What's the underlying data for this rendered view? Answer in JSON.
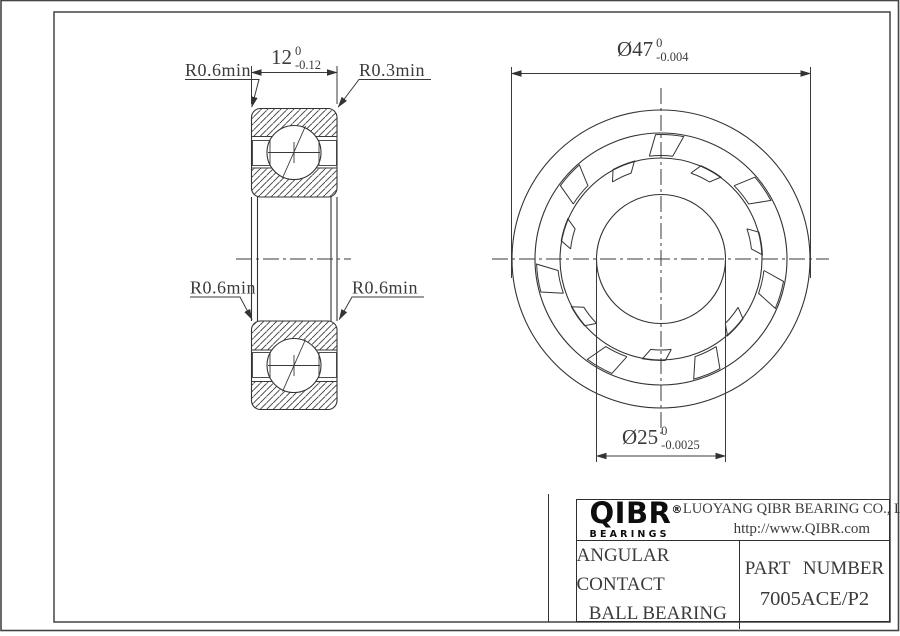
{
  "left_view": {
    "width_dim": {
      "value": "12",
      "tol_upper": "0",
      "tol_lower": "-0.12"
    },
    "radius_top_left": "R0.6min",
    "radius_top_right": "R0.3min",
    "radius_mid_left": "R0.6min",
    "radius_mid_right": "R0.6min"
  },
  "front_view": {
    "outer_dia": {
      "value": "Ø47",
      "tol_upper": "0",
      "tol_lower": "-0.004"
    },
    "bore_dia": {
      "value": "Ø25",
      "tol_upper": "0",
      "tol_lower": "-0.0025"
    }
  },
  "title_block": {
    "logo_text": "QIBR",
    "logo_registered": "®",
    "logo_tagline": "BEARINGS",
    "company_name": "LUOYANG QIBR BEARING CO., LTD",
    "website": "http://www.QIBR.com",
    "product_name_line1": "ANGULAR CONTACT",
    "product_name_line2": "BALL BEARING",
    "part_number_label": "PART NUMBER",
    "part_number": "7005ACE/P2"
  }
}
